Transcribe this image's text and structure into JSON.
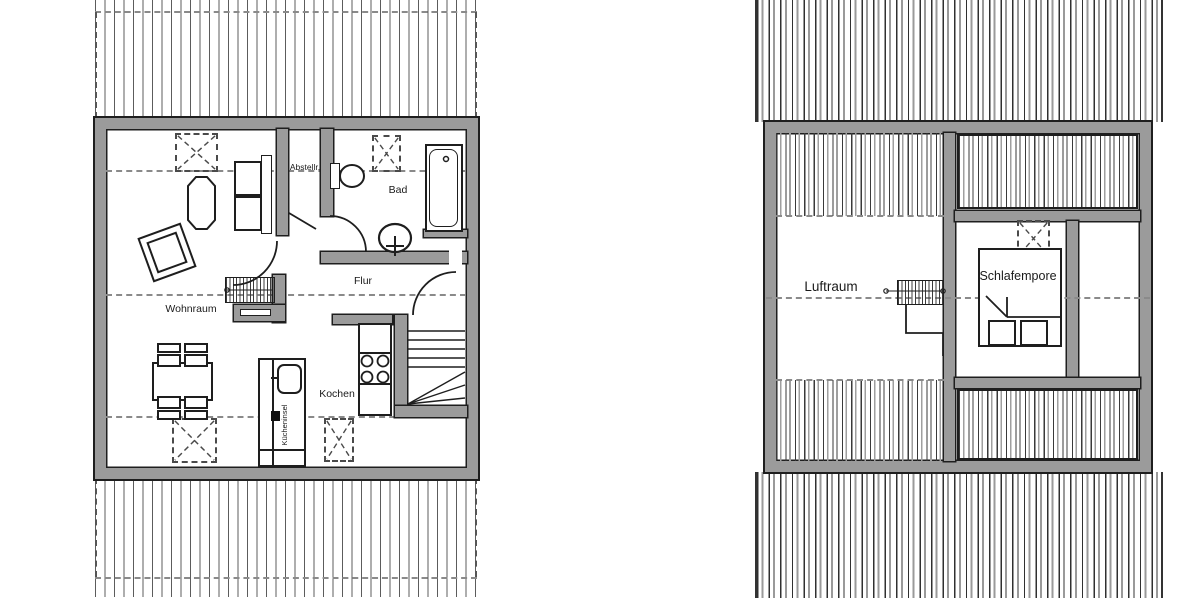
{
  "colors": {
    "wall_fill": "#9b9b9b",
    "line": "#1e1e1e",
    "dash_line": "#8a8a8a",
    "background": "#ffffff"
  },
  "left_plan": {
    "rooms": {
      "wohnraum": "Wohnraum",
      "abstellraum": "Abstellr.",
      "bad": "Bad",
      "flur": "Flur",
      "kochen": "Kochen",
      "kuecheninsel": "Kücheninsel"
    }
  },
  "right_plan": {
    "rooms": {
      "luftraum": "Luftraum",
      "schlafempore": "Schlafempore"
    }
  }
}
